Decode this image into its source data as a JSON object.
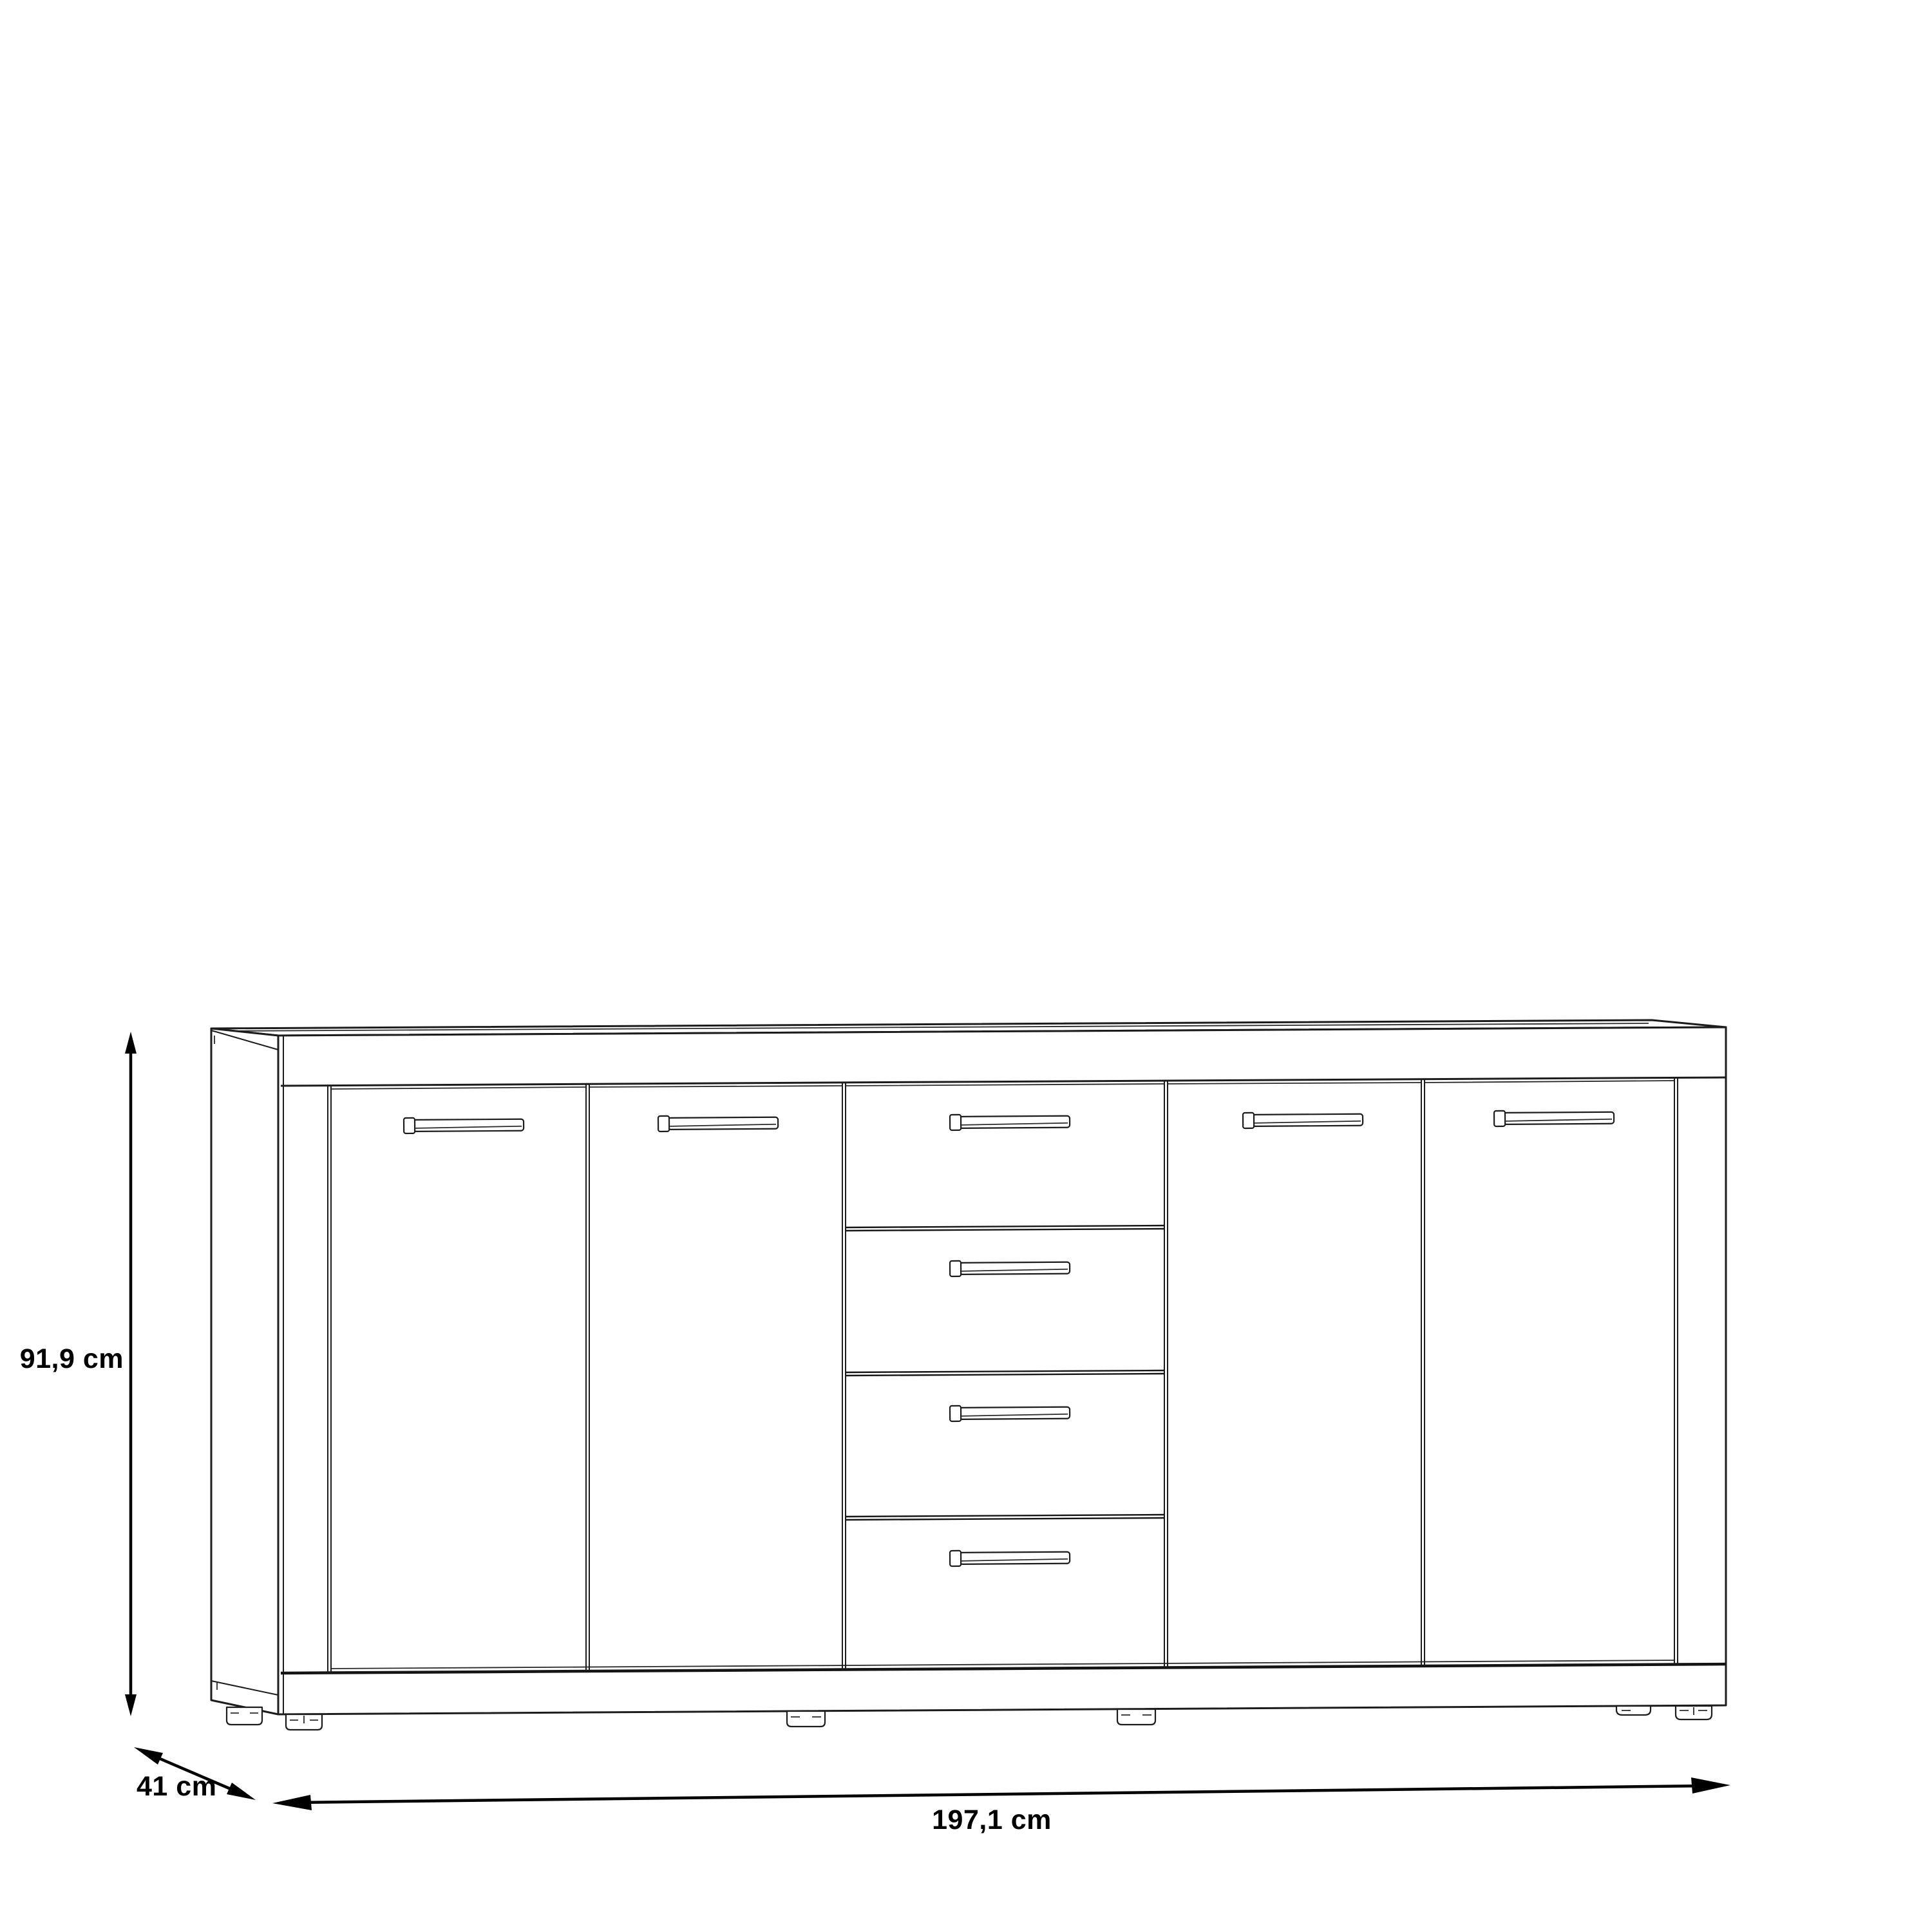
{
  "diagram": {
    "kind": "furniture-dimension-line-drawing",
    "object": "sideboard with 4 doors and 4 center drawers",
    "background_color": "#ffffff",
    "line_color": "#1c1c1c",
    "dimension_color": "#000000",
    "labels": {
      "height": "91,9 cm",
      "depth": "41 cm",
      "width": "197,1 cm"
    },
    "dimensions": {
      "height_value": "91,9",
      "depth_value": "41",
      "width_value": "197,1",
      "unit": "cm"
    },
    "structure": {
      "doors": 4,
      "drawers": 4,
      "door_handles": 4,
      "drawer_handles": 4,
      "visible_feet": 6
    }
  }
}
